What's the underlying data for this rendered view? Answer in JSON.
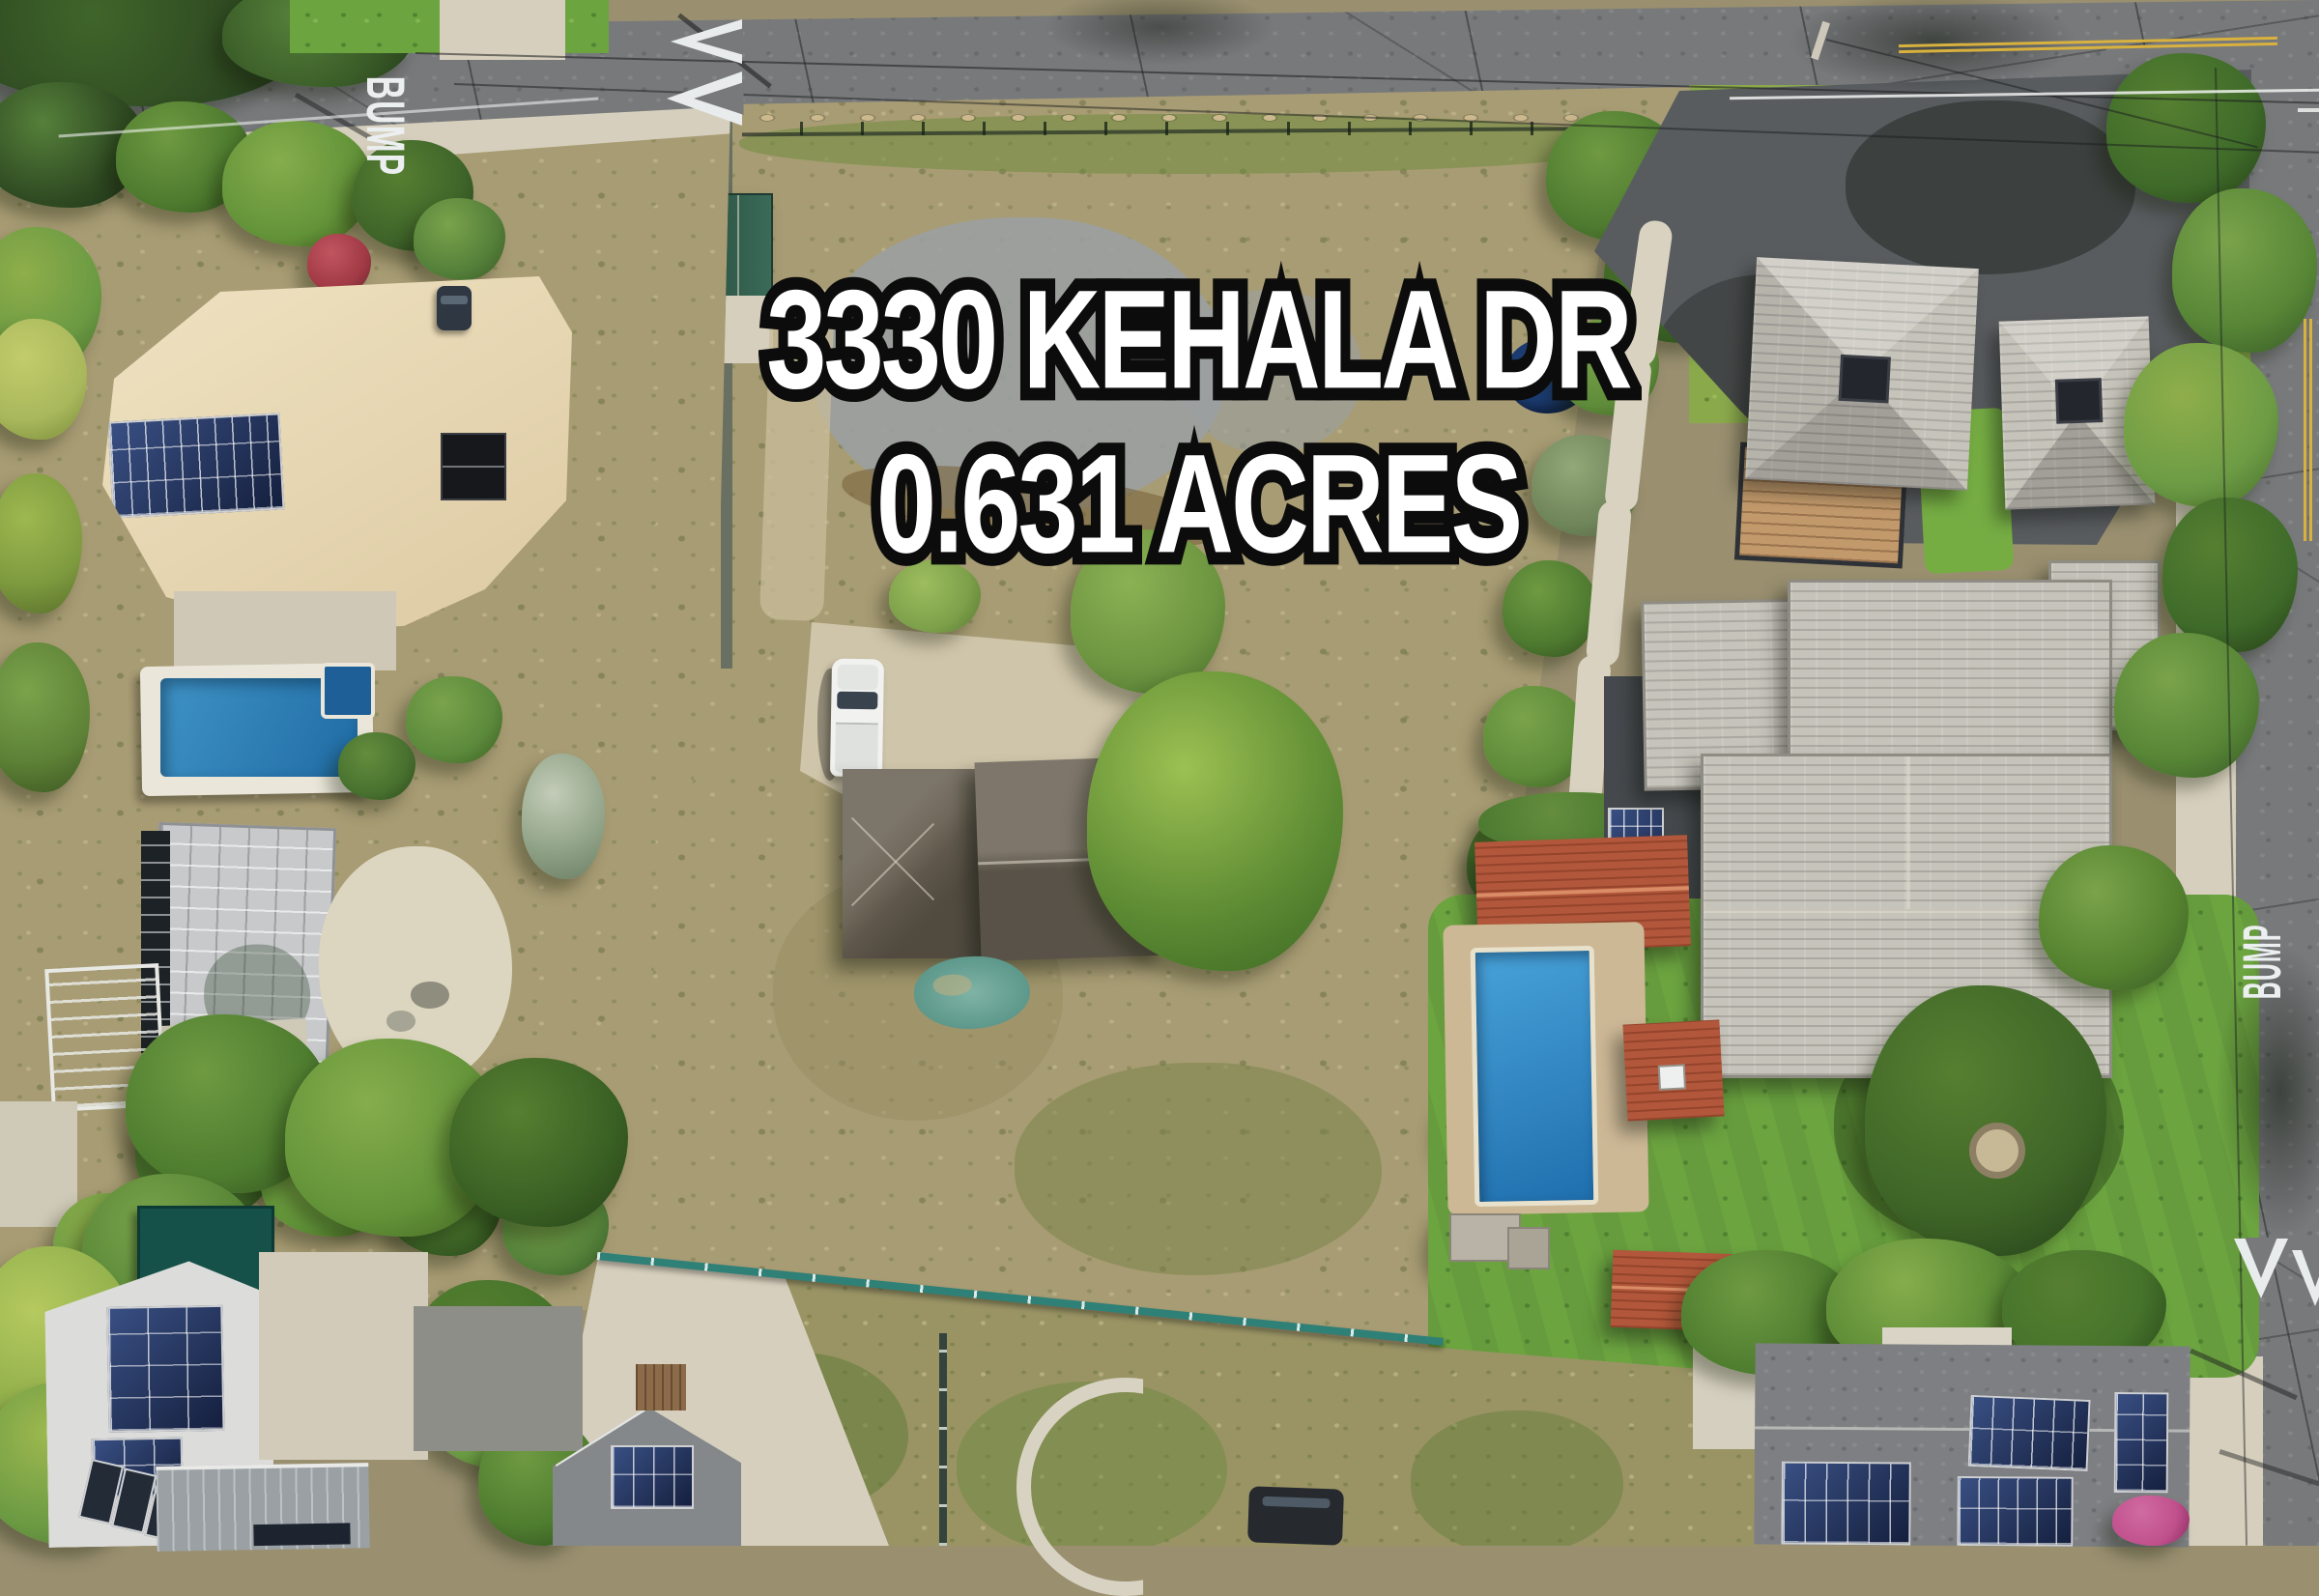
{
  "overlay": {
    "line1": "3330 KEHALA DR",
    "line2": "0.631 ACRES",
    "text_color": "#ffffff",
    "outline_color": "#0c0c0c"
  },
  "road_markings": {
    "bump_top": "BUMP",
    "bump_right": "BUMP",
    "marking_color": "#eceff0",
    "center_line_color": "#d9b23e"
  },
  "icons": {
    "speed-hump-chevrons-top": "double-hollow-triangle-left",
    "speed-hump-chevrons-bottom-right": "double-hollow-triangle-down"
  },
  "palette": {
    "asphalt": "#77797b",
    "asphalt_dark": "#595c5f",
    "concrete": "#d6cfbd",
    "dry_lot_brush": "#a89c74",
    "dry_field": "#9a9465",
    "lawn_green": "#6ca440",
    "tree_green": "#4e7d2f",
    "tan_roof": "#e8d9b8",
    "gray_tile_roof": "#c6c3ba",
    "red_tile_roof": "#b2573b",
    "dark_shingle_roof": "#675f51",
    "solar_panel_blue": "#1e2d4e",
    "pool_water": "#2b8ac4",
    "teal_fence": "#2f8076",
    "shade_canopy_teal": "#15524a",
    "blue_tarp": "#1c3c72"
  }
}
